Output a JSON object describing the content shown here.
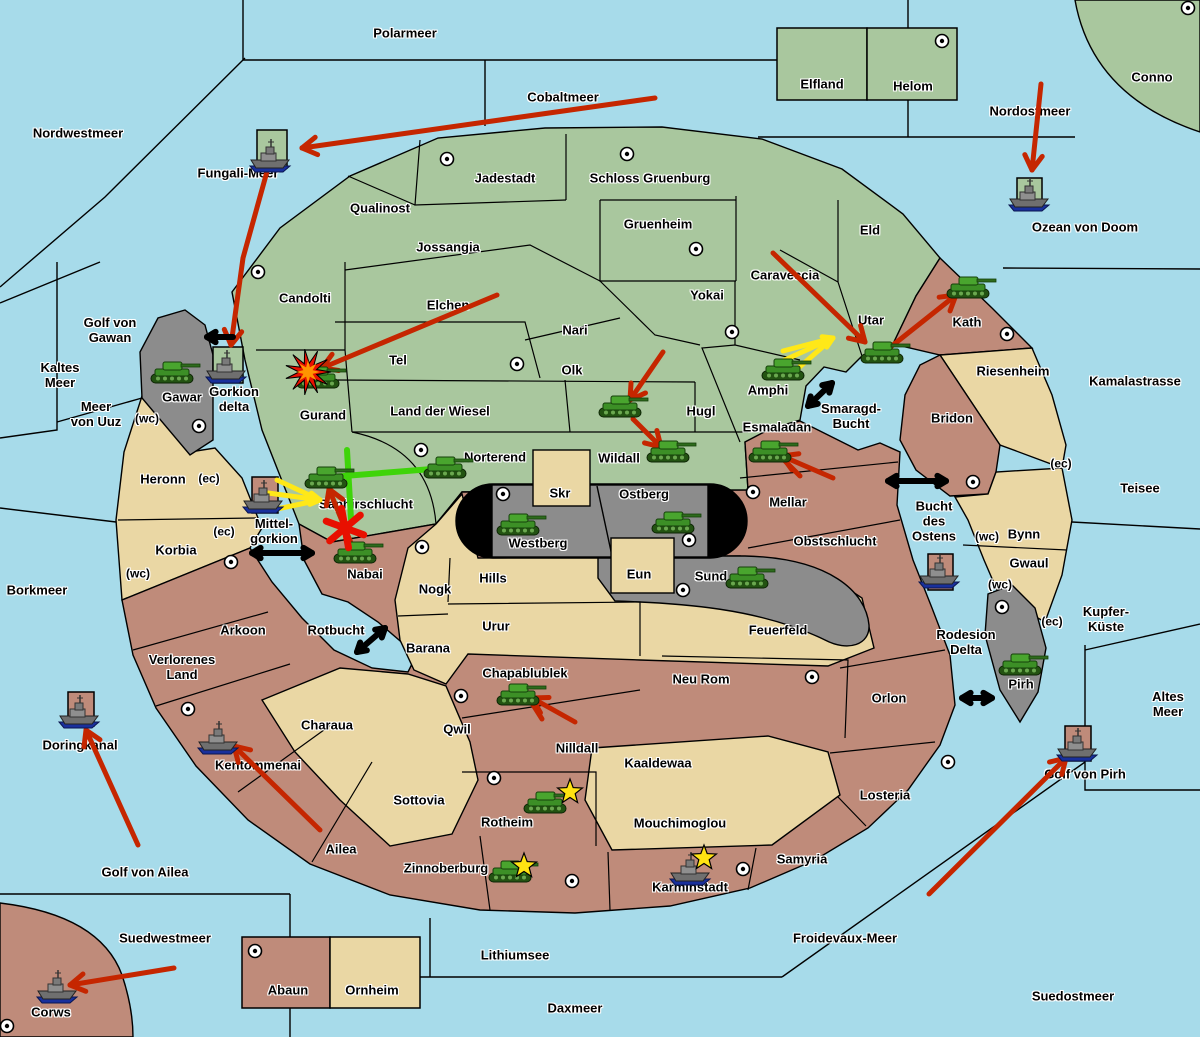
{
  "map": {
    "title": "strategy-war-map",
    "colors": {
      "sea": "#a7dbea",
      "green_land": "#a9c79e",
      "tan_land": "#ead7a4",
      "red_land": "#bf8b7a",
      "gray_land": "#8c8c8c",
      "cap_black": "#000000",
      "attack_red": "#c52600",
      "move_yellow": "#ffe818",
      "support_green": "#3fd40a",
      "star_yellow": "#ffe312",
      "explosion_core": "#ff9500"
    },
    "sea_labels": [
      {
        "t": "Polarmeer",
        "x": 405,
        "y": 33
      },
      {
        "t": "Nordwestmeer",
        "x": 78,
        "y": 133
      },
      {
        "t": "Cobaltmeer",
        "x": 563,
        "y": 97
      },
      {
        "t": "Fungali-Meer",
        "x": 238,
        "y": 173
      },
      {
        "t": "Nordostmeer",
        "x": 1030,
        "y": 111
      },
      {
        "t": "Ozean von Doom",
        "x": 1085,
        "y": 227
      },
      {
        "l": [
          "Golf von",
          "Gawan"
        ],
        "x": 110,
        "y": 330
      },
      {
        "l": [
          "Kaltes",
          "Meer"
        ],
        "x": 60,
        "y": 375
      },
      {
        "l": [
          "Meer",
          "von Uuz"
        ],
        "x": 96,
        "y": 414
      },
      {
        "t": "Borkmeer",
        "x": 37,
        "y": 590
      },
      {
        "t": "Doringkanal",
        "x": 80,
        "y": 745
      },
      {
        "t": "Golf von Ailea",
        "x": 145,
        "y": 872
      },
      {
        "t": "Suedwestmeer",
        "x": 165,
        "y": 938
      },
      {
        "t": "Lithiumsee",
        "x": 515,
        "y": 955
      },
      {
        "t": "Daxmeer",
        "x": 575,
        "y": 1008
      },
      {
        "t": "Froidevaux-Meer",
        "x": 845,
        "y": 938
      },
      {
        "t": "Suedostmeer",
        "x": 1073,
        "y": 996
      },
      {
        "t": "Golf von Pirh",
        "x": 1085,
        "y": 774
      },
      {
        "l": [
          "Altes",
          "Meer"
        ],
        "x": 1168,
        "y": 704
      },
      {
        "l": [
          "Kupfer-",
          "Küste"
        ],
        "x": 1106,
        "y": 619
      },
      {
        "t": "Teisee",
        "x": 1140,
        "y": 488
      },
      {
        "t": "Kamalastrasse",
        "x": 1135,
        "y": 381
      },
      {
        "l": [
          "Smaragd-",
          "Bucht"
        ],
        "x": 851,
        "y": 416
      },
      {
        "l": [
          "Bucht",
          "des",
          "Ostens"
        ],
        "x": 934,
        "y": 521
      },
      {
        "l": [
          "Rodesion",
          "Delta"
        ],
        "x": 966,
        "y": 642
      },
      {
        "t": "Rotbucht",
        "x": 336,
        "y": 630
      },
      {
        "l": [
          "Mittel-",
          "gorkion"
        ],
        "x": 274,
        "y": 531
      }
    ],
    "region_labels": [
      {
        "t": "Qualinost",
        "x": 380,
        "y": 208
      },
      {
        "t": "Jadestadt",
        "x": 505,
        "y": 178
      },
      {
        "t": "Schloss Gruenburg",
        "x": 650,
        "y": 178
      },
      {
        "t": "Gruenheim",
        "x": 658,
        "y": 224
      },
      {
        "t": "Jossangia",
        "x": 448,
        "y": 247
      },
      {
        "t": "Eld",
        "x": 870,
        "y": 230
      },
      {
        "t": "Candolti",
        "x": 305,
        "y": 298
      },
      {
        "t": "Elchen",
        "x": 448,
        "y": 305
      },
      {
        "t": "Yokai",
        "x": 707,
        "y": 295
      },
      {
        "t": "Caraveccia",
        "x": 785,
        "y": 275
      },
      {
        "t": "Nari",
        "x": 575,
        "y": 330
      },
      {
        "t": "Olk",
        "x": 572,
        "y": 370
      },
      {
        "t": "Tel",
        "x": 398,
        "y": 360
      },
      {
        "t": "Utar",
        "x": 871,
        "y": 320
      },
      {
        "t": "Gurand",
        "x": 323,
        "y": 415
      },
      {
        "t": "Land der Wiesel",
        "x": 440,
        "y": 411
      },
      {
        "t": "Amphi",
        "x": 768,
        "y": 390
      },
      {
        "t": "Hugl",
        "x": 701,
        "y": 411
      },
      {
        "t": "Wildall",
        "x": 619,
        "y": 458
      },
      {
        "t": "Norterend",
        "x": 495,
        "y": 457
      },
      {
        "t": "Saphirschlucht",
        "x": 366,
        "y": 504
      },
      {
        "t": "Elfland",
        "x": 822,
        "y": 84
      },
      {
        "t": "Helom",
        "x": 913,
        "y": 86
      },
      {
        "t": "Conno",
        "x": 1152,
        "y": 77
      },
      {
        "t": "Kath",
        "x": 967,
        "y": 322
      },
      {
        "t": "Riesenheim",
        "x": 1013,
        "y": 371
      },
      {
        "t": "Bridon",
        "x": 952,
        "y": 418
      },
      {
        "t": "Bynn",
        "x": 1024,
        "y": 534
      },
      {
        "t": "Gwaul",
        "x": 1029,
        "y": 563
      },
      {
        "t": "Pirh",
        "x": 1021,
        "y": 684
      },
      {
        "t": "Esmaladan",
        "x": 777,
        "y": 427
      },
      {
        "t": "Mellar",
        "x": 788,
        "y": 502
      },
      {
        "t": "Obstschlucht",
        "x": 835,
        "y": 541
      },
      {
        "t": "Gawar",
        "x": 182,
        "y": 397
      },
      {
        "t": "Westberg",
        "x": 538,
        "y": 543
      },
      {
        "t": "Ostberg",
        "x": 644,
        "y": 494
      },
      {
        "t": "Skr",
        "x": 560,
        "y": 493
      },
      {
        "t": "Sund",
        "x": 711,
        "y": 576
      },
      {
        "t": "Eun",
        "x": 639,
        "y": 574
      },
      {
        "l": [
          "Gorkion",
          "delta"
        ],
        "x": 234,
        "y": 399
      },
      {
        "t": "Heronn",
        "x": 163,
        "y": 479
      },
      {
        "t": "Korbia",
        "x": 176,
        "y": 550
      },
      {
        "t": "Arkoon",
        "x": 243,
        "y": 630
      },
      {
        "l": [
          "Verlorenes",
          "Land"
        ],
        "x": 182,
        "y": 667
      },
      {
        "t": "Kentommenai",
        "x": 258,
        "y": 765
      },
      {
        "t": "Ailea",
        "x": 341,
        "y": 849
      },
      {
        "t": "Nabai",
        "x": 365,
        "y": 574
      },
      {
        "t": "Nogk",
        "x": 435,
        "y": 589
      },
      {
        "t": "Hills",
        "x": 493,
        "y": 578
      },
      {
        "t": "Urur",
        "x": 496,
        "y": 626
      },
      {
        "t": "Feuerfeld",
        "x": 778,
        "y": 630
      },
      {
        "t": "Barana",
        "x": 428,
        "y": 648
      },
      {
        "t": "Charaua",
        "x": 327,
        "y": 725
      },
      {
        "t": "Qwil",
        "x": 457,
        "y": 729
      },
      {
        "t": "Chapablublek",
        "x": 525,
        "y": 673
      },
      {
        "t": "Nilldall",
        "x": 577,
        "y": 748
      },
      {
        "t": "Kaaldewaa",
        "x": 658,
        "y": 763
      },
      {
        "t": "Neu Rom",
        "x": 701,
        "y": 679
      },
      {
        "t": "Sottovia",
        "x": 419,
        "y": 800
      },
      {
        "t": "Rotheim",
        "x": 507,
        "y": 822
      },
      {
        "t": "Mouchimoglou",
        "x": 680,
        "y": 823
      },
      {
        "t": "Zinnoberburg",
        "x": 446,
        "y": 868
      },
      {
        "t": "Karminstadt",
        "x": 690,
        "y": 887
      },
      {
        "t": "Samyria",
        "x": 802,
        "y": 859
      },
      {
        "t": "Losteria",
        "x": 885,
        "y": 795
      },
      {
        "t": "Orlon",
        "x": 889,
        "y": 698
      },
      {
        "t": "Corws",
        "x": 51,
        "y": 1012
      },
      {
        "t": "Abaun",
        "x": 288,
        "y": 990
      },
      {
        "t": "Ornheim",
        "x": 372,
        "y": 990
      }
    ],
    "coast_tags": [
      {
        "t": "(wc)",
        "x": 147,
        "y": 419
      },
      {
        "t": "(ec)",
        "x": 209,
        "y": 479
      },
      {
        "t": "(ec)",
        "x": 224,
        "y": 532
      },
      {
        "t": "(wc)",
        "x": 138,
        "y": 574
      },
      {
        "t": "(ec)",
        "x": 1061,
        "y": 464
      },
      {
        "t": "(wc)",
        "x": 987,
        "y": 537
      },
      {
        "t": "(wc)",
        "x": 1000,
        "y": 585
      },
      {
        "t": "(ec)",
        "x": 1052,
        "y": 622
      }
    ],
    "cities": [
      [
        447,
        159
      ],
      [
        627,
        154
      ],
      [
        696,
        249
      ],
      [
        942,
        41
      ],
      [
        1188,
        8
      ],
      [
        258,
        272
      ],
      [
        517,
        364
      ],
      [
        421,
        450
      ],
      [
        732,
        332
      ],
      [
        1007,
        334
      ],
      [
        973,
        482
      ],
      [
        199,
        426
      ],
      [
        753,
        492
      ],
      [
        503,
        494
      ],
      [
        689,
        540
      ],
      [
        683,
        590
      ],
      [
        422,
        547
      ],
      [
        231,
        562
      ],
      [
        188,
        709
      ],
      [
        461,
        696
      ],
      [
        494,
        778
      ],
      [
        572,
        881
      ],
      [
        743,
        869
      ],
      [
        948,
        762
      ],
      [
        812,
        677
      ],
      [
        255,
        951
      ],
      [
        7,
        1026
      ],
      [
        1002,
        607
      ]
    ],
    "tanks": [
      [
        172,
        373
      ],
      [
        318,
        378
      ],
      [
        326,
        478
      ],
      [
        445,
        468
      ],
      [
        355,
        553
      ],
      [
        620,
        407
      ],
      [
        668,
        452
      ],
      [
        770,
        452
      ],
      [
        882,
        353
      ],
      [
        968,
        288
      ],
      [
        783,
        370
      ],
      [
        518,
        525
      ],
      [
        673,
        523
      ],
      [
        747,
        578
      ],
      [
        1020,
        665
      ],
      [
        518,
        695
      ],
      [
        545,
        803
      ],
      [
        510,
        872
      ]
    ],
    "ships": [
      [
        270,
        155
      ],
      [
        226,
        366
      ],
      [
        263,
        496
      ],
      [
        79,
        711
      ],
      [
        218,
        737
      ],
      [
        57,
        986
      ],
      [
        690,
        868
      ],
      [
        939,
        571
      ],
      [
        1029,
        194
      ],
      [
        1077,
        744
      ]
    ],
    "stars": [
      [
        570,
        792
      ],
      [
        524,
        866
      ],
      [
        704,
        858
      ]
    ],
    "explosions": [
      {
        "x": 308,
        "y": 372,
        "kind": "burst"
      },
      {
        "x": 345,
        "y": 528,
        "kind": "cross"
      }
    ],
    "red_arrows": [
      {
        "pts": [
          [
            655,
            98
          ],
          [
            302,
            148
          ]
        ]
      },
      {
        "pts": [
          [
            268,
            168
          ],
          [
            243,
            258
          ],
          [
            231,
            345
          ]
        ]
      },
      {
        "pts": [
          [
            497,
            295
          ],
          [
            322,
            368
          ]
        ]
      },
      {
        "pts": [
          [
            773,
            253
          ],
          [
            865,
            342
          ]
        ]
      },
      {
        "pts": [
          [
            888,
            349
          ],
          [
            956,
            295
          ]
        ]
      },
      {
        "pts": [
          [
            663,
            352
          ],
          [
            630,
            400
          ]
        ]
      },
      {
        "pts": [
          [
            633,
            419
          ],
          [
            661,
            447
          ]
        ]
      },
      {
        "pts": [
          [
            833,
            478
          ],
          [
            782,
            456
          ]
        ]
      },
      {
        "pts": [
          [
            800,
            476
          ],
          [
            784,
            460
          ]
        ],
        "nohead": true
      },
      {
        "pts": [
          [
            353,
            548
          ],
          [
            329,
            489
          ]
        ]
      },
      {
        "pts": [
          [
            575,
            722
          ],
          [
            532,
            698
          ]
        ]
      },
      {
        "pts": [
          [
            542,
            719
          ],
          [
            530,
            700
          ]
        ],
        "nohead": true
      },
      {
        "pts": [
          [
            320,
            830
          ],
          [
            234,
            746
          ]
        ]
      },
      {
        "pts": [
          [
            138,
            845
          ],
          [
            86,
            730
          ]
        ]
      },
      {
        "pts": [
          [
            174,
            968
          ],
          [
            70,
            985
          ]
        ]
      },
      {
        "pts": [
          [
            929,
            894
          ],
          [
            1066,
            758
          ]
        ]
      },
      {
        "pts": [
          [
            1041,
            84
          ],
          [
            1032,
            170
          ]
        ]
      }
    ],
    "yellow_arrows": [
      {
        "tip": [
          320,
          500
        ],
        "tails": [
          [
            277,
            480
          ],
          [
            268,
            493
          ],
          [
            277,
            509
          ]
        ]
      },
      {
        "tip": [
          833,
          338
        ],
        "tails": [
          [
            783,
            351
          ],
          [
            776,
            364
          ],
          [
            788,
            377
          ]
        ]
      }
    ],
    "green_moves": [
      {
        "line": [
          [
            445,
            468
          ],
          [
            331,
            477
          ]
        ],
        "bar": [
          [
            347,
            450
          ],
          [
            351,
            519
          ]
        ]
      }
    ],
    "black_double_arrows": [
      [
        252,
        553,
        312,
        553
      ],
      [
        357,
        652,
        385,
        628
      ],
      [
        808,
        406,
        832,
        383
      ],
      [
        888,
        481,
        946,
        481
      ],
      [
        962,
        698,
        992,
        698
      ]
    ],
    "black_single_arrows": [
      [
        233,
        337,
        207,
        337
      ]
    ]
  }
}
